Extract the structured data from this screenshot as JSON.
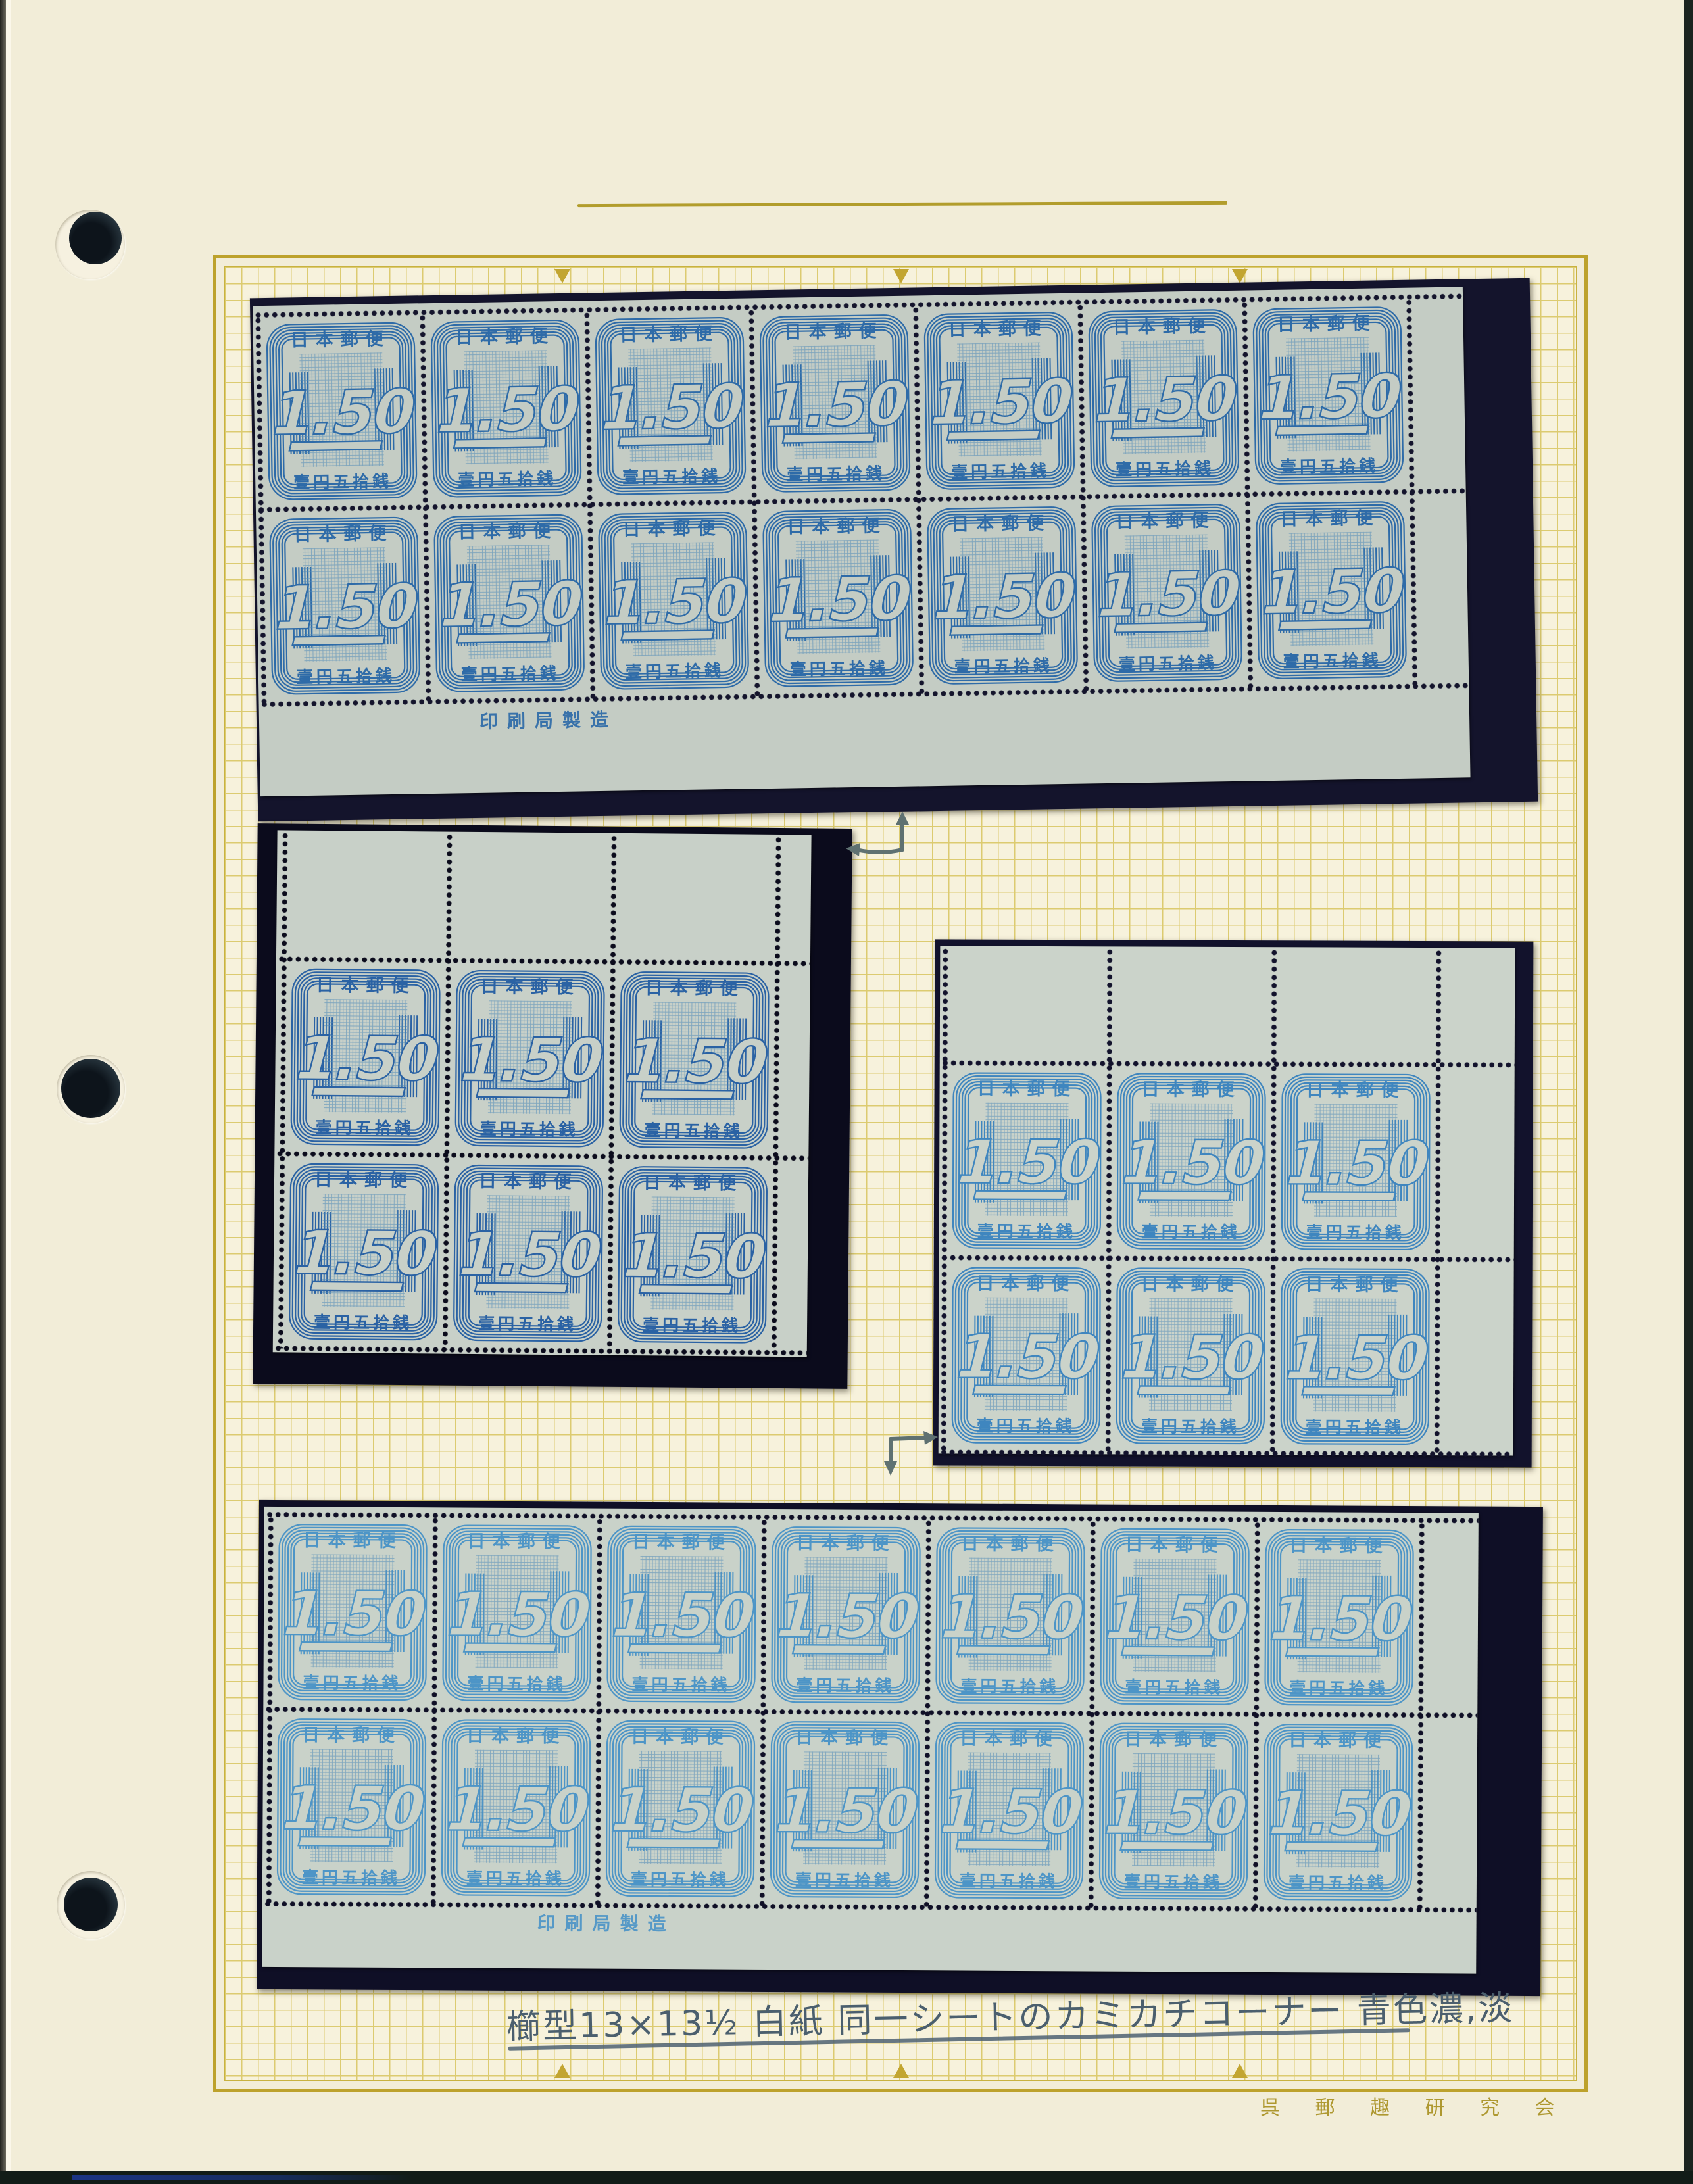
{
  "page": {
    "kind": "stamp album page",
    "annotation": "櫛型13×13½  白紙 同一シートのカミカチコーナー 青色濃,淡",
    "club_name": "呉 郵 趣 研 究 会",
    "accent_colors": {
      "frame_gold": "#bda22c",
      "grid_line": "#dccb70",
      "handwriting_ink": "#4b5f6e",
      "club_text": "#ae9830"
    }
  },
  "stamp": {
    "country_text": "日本郵便",
    "denomination": "1.50",
    "denomination_kanji": "壹円五拾銭",
    "marginal_imprint": "印刷局製造"
  },
  "blocks": [
    {
      "position": "top",
      "cols": 7,
      "rows": 2,
      "stamp_count": 14,
      "shade": "dark",
      "ink": "#2e6ba8",
      "paper": "#c4ccc4",
      "mat": "#14142c",
      "selvage": "bottom",
      "has_imprint": true
    },
    {
      "position": "middle-left",
      "cols": 3,
      "rows": 2,
      "stamp_count": 6,
      "shade": "dark",
      "ink": "#2a62a4",
      "paper": "#c8d0c8",
      "mat": "#0b0b1c",
      "selvage": "top",
      "has_imprint": false
    },
    {
      "position": "middle-right",
      "cols": 3,
      "rows": 2,
      "stamp_count": 6,
      "shade": "light",
      "ink": "#3f86bf",
      "paper": "#cbd3ca",
      "mat": "#12122c",
      "selvage": "top",
      "has_imprint": false
    },
    {
      "position": "bottom",
      "cols": 7,
      "rows": 2,
      "stamp_count": 14,
      "shade": "light",
      "ink": "#4d95c7",
      "paper": "#c9d2c9",
      "mat": "#0f0f26",
      "selvage": "bottom",
      "has_imprint": true
    }
  ]
}
